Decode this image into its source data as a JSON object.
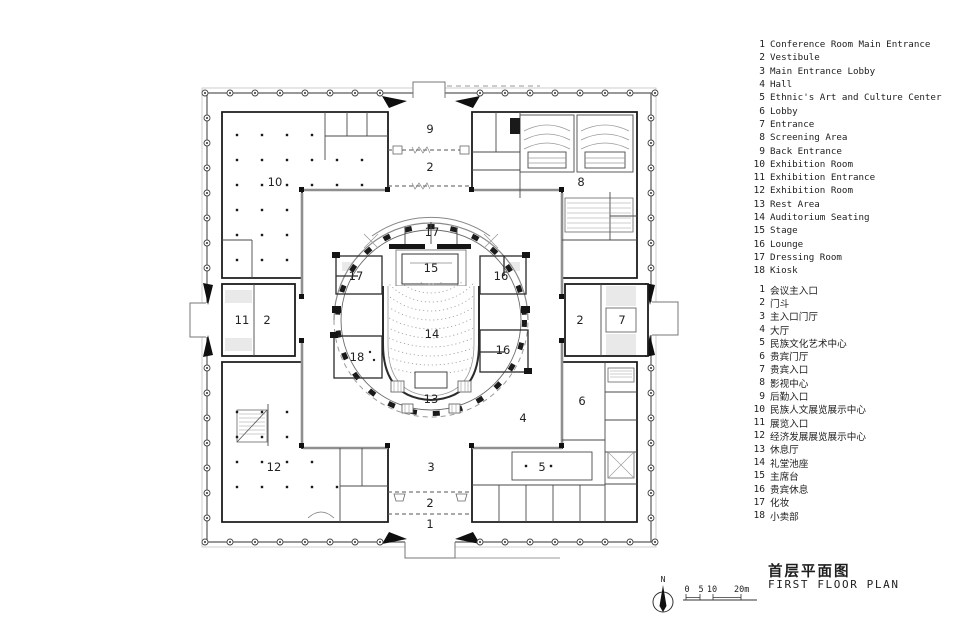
{
  "legend_en": {
    "items": [
      {
        "num": "1",
        "label": "Conference Room Main Entrance"
      },
      {
        "num": "2",
        "label": "Vestibule"
      },
      {
        "num": "3",
        "label": "Main Entrance Lobby"
      },
      {
        "num": "4",
        "label": "Hall"
      },
      {
        "num": "5",
        "label": "Ethnic's Art and Culture Center"
      },
      {
        "num": "6",
        "label": "Lobby"
      },
      {
        "num": "7",
        "label": "Entrance"
      },
      {
        "num": "8",
        "label": "Screening Area"
      },
      {
        "num": "9",
        "label": "Back Entrance"
      },
      {
        "num": "10",
        "label": "Exhibition Room"
      },
      {
        "num": "11",
        "label": "Exhibition Entrance"
      },
      {
        "num": "12",
        "label": "Exhibition Room"
      },
      {
        "num": "13",
        "label": "Rest Area"
      },
      {
        "num": "14",
        "label": "Auditorium Seating"
      },
      {
        "num": "15",
        "label": "Stage"
      },
      {
        "num": "16",
        "label": "Lounge"
      },
      {
        "num": "17",
        "label": "Dressing Room"
      },
      {
        "num": "18",
        "label": "Kiosk"
      }
    ]
  },
  "legend_zh": {
    "items": [
      {
        "num": "1",
        "label": "会议主入口"
      },
      {
        "num": "2",
        "label": "门斗"
      },
      {
        "num": "3",
        "label": "主入口门厅"
      },
      {
        "num": "4",
        "label": "大厅"
      },
      {
        "num": "5",
        "label": "民族文化艺术中心"
      },
      {
        "num": "6",
        "label": "贵宾门厅"
      },
      {
        "num": "7",
        "label": "贵宾入口"
      },
      {
        "num": "8",
        "label": "影视中心"
      },
      {
        "num": "9",
        "label": "后勤入口"
      },
      {
        "num": "10",
        "label": "民族人文展览展示中心"
      },
      {
        "num": "11",
        "label": "展览入口"
      },
      {
        "num": "12",
        "label": "经济发展展览展示中心"
      },
      {
        "num": "13",
        "label": "休息厅"
      },
      {
        "num": "14",
        "label": "礼堂池座"
      },
      {
        "num": "15",
        "label": "主席台"
      },
      {
        "num": "16",
        "label": "贵宾休息"
      },
      {
        "num": "17",
        "label": "化妆"
      },
      {
        "num": "18",
        "label": "小卖部"
      }
    ]
  },
  "plan": {
    "room_labels": [
      {
        "n": "9",
        "x": 430,
        "y": 129
      },
      {
        "n": "2",
        "x": 430,
        "y": 167
      },
      {
        "n": "10",
        "x": 275,
        "y": 182
      },
      {
        "n": "8",
        "x": 581,
        "y": 182
      },
      {
        "n": "17",
        "x": 432,
        "y": 232
      },
      {
        "n": "15",
        "x": 431,
        "y": 268
      },
      {
        "n": "17",
        "x": 356,
        "y": 276
      },
      {
        "n": "16",
        "x": 501,
        "y": 276
      },
      {
        "n": "11",
        "x": 242,
        "y": 320
      },
      {
        "n": "2",
        "x": 267,
        "y": 320
      },
      {
        "n": "2",
        "x": 580,
        "y": 320
      },
      {
        "n": "7",
        "x": 622,
        "y": 320
      },
      {
        "n": "14",
        "x": 432,
        "y": 334
      },
      {
        "n": "16",
        "x": 503,
        "y": 350
      },
      {
        "n": "18",
        "x": 357,
        "y": 357
      },
      {
        "n": "13",
        "x": 431,
        "y": 399
      },
      {
        "n": "6",
        "x": 582,
        "y": 401
      },
      {
        "n": "4",
        "x": 523,
        "y": 418
      },
      {
        "n": "12",
        "x": 274,
        "y": 467
      },
      {
        "n": "3",
        "x": 431,
        "y": 467
      },
      {
        "n": "5",
        "x": 542,
        "y": 467
      },
      {
        "n": "2",
        "x": 430,
        "y": 503
      },
      {
        "n": "1",
        "x": 430,
        "y": 524
      }
    ]
  },
  "titleblock": {
    "title_zh": "首层平面图",
    "title_en": "FIRST FLOOR PLAN",
    "north_label": "N",
    "scale": {
      "t0": "0",
      "t1": "5",
      "t2": "10",
      "t3": "20m"
    }
  },
  "colors": {
    "ink": "#1c1c1c",
    "paper": "#ffffff",
    "wall_gray": "#8f8f8f",
    "fill_gray": "#e9e9e9"
  }
}
